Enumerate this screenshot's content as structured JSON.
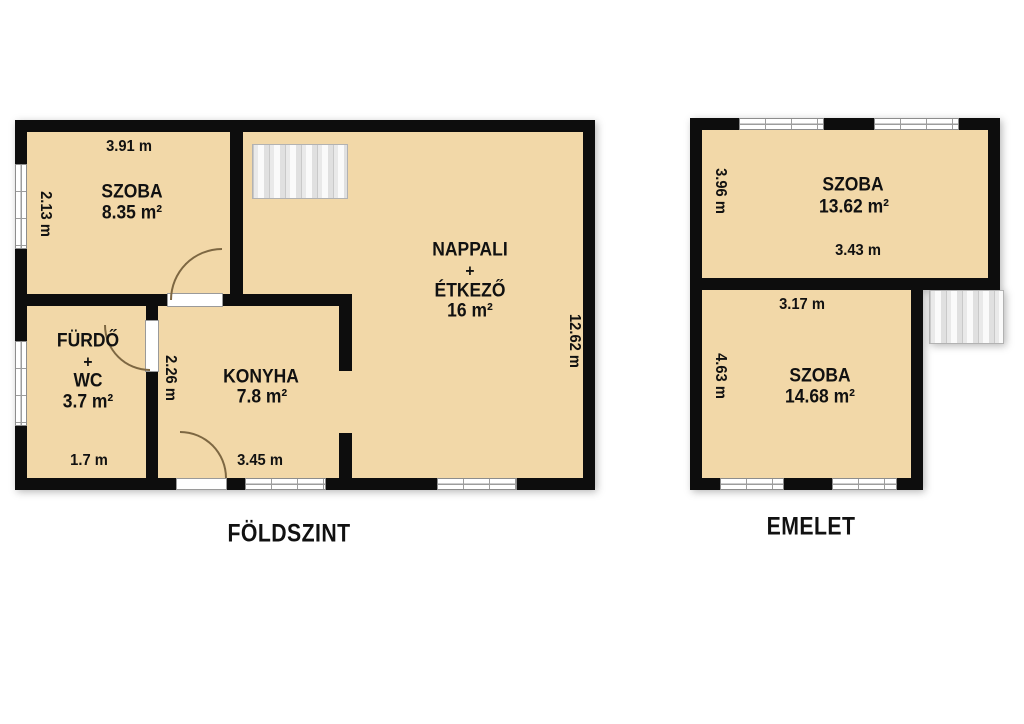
{
  "ground": {
    "title": "FÖLDSZINT",
    "szoba": {
      "name": "SZOBA",
      "area": "8.35 m²",
      "width": "3.91 m",
      "depth": "2.13 m"
    },
    "nappali": {
      "name": "NAPPALI",
      "plus": "+",
      "name2": "ÉTKEZŐ",
      "area": "16 m²",
      "depth": "12.62 m"
    },
    "furdo": {
      "name": "FÜRDŐ",
      "plus": "+",
      "name2": "WC",
      "area": "3.7 m²",
      "width": "1.7 m"
    },
    "konyha": {
      "name": "KONYHA",
      "area": "7.8 m²",
      "width": "3.45 m",
      "depth": "2.26 m"
    }
  },
  "upper": {
    "title": "EMELET",
    "szoba_top": {
      "name": "SZOBA",
      "area": "13.62 m²",
      "depth": "3.96 m",
      "width": "3.43 m"
    },
    "szoba_bottom": {
      "name": "SZOBA",
      "area": "14.68 m²",
      "width": "3.17 m",
      "depth": "4.63 m"
    }
  },
  "colors": {
    "wall": "#0d0d0d",
    "floor": "#f2d8a8",
    "background": "#ffffff",
    "stairs": "#e9e9e9"
  }
}
